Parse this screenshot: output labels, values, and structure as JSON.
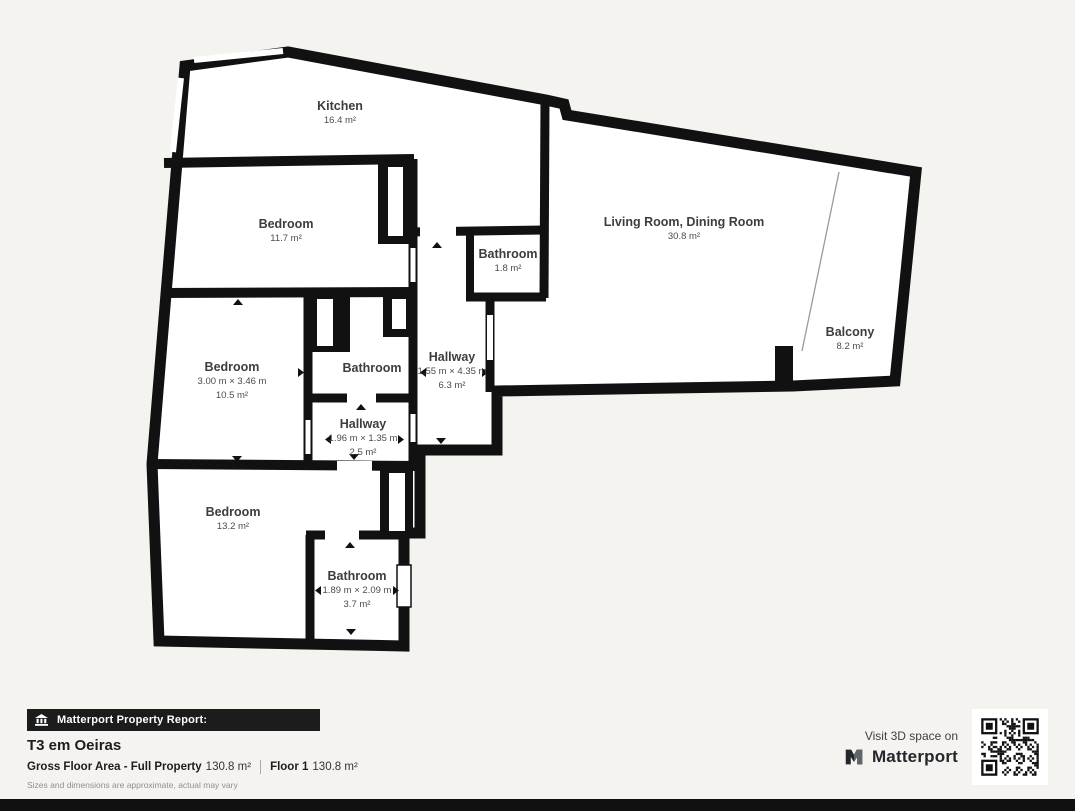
{
  "plan": {
    "rooms": [
      {
        "name": "Kitchen",
        "area": "16.4 m²"
      },
      {
        "name": "Bedroom",
        "area": "11.7 m²"
      },
      {
        "name": "Bathroom",
        "area": "1.8 m²"
      },
      {
        "name": "Living Room, Dining Room",
        "area": "30.8 m²"
      },
      {
        "name": "Balcony",
        "area": "8.2 m²"
      },
      {
        "name": "Bedroom",
        "dims": "3.00 m × 3.46 m",
        "area": "10.5 m²"
      },
      {
        "name": "Bathroom"
      },
      {
        "name": "Hallway",
        "dims": "1.55 m × 4.35 m",
        "area": "6.3 m²"
      },
      {
        "name": "Hallway",
        "dims": "1.96 m × 1.35 m",
        "area": "2.5 m²"
      },
      {
        "name": "Bedroom",
        "area": "13.2 m²"
      },
      {
        "name": "Bathroom",
        "dims": "1.89 m × 2.09 m",
        "area": "3.7 m²"
      }
    ]
  },
  "report": {
    "header": "Matterport Property Report:",
    "title": "T3 em Oeiras",
    "gross_label": "Gross Floor Area - Full Property",
    "gross_value": "130.8 m²",
    "floor_label": "Floor 1",
    "floor_value": "130.8 m²",
    "disclaimer": "Sizes and dimensions are approximate, actual may vary"
  },
  "cta": {
    "visit": "Visit 3D space on",
    "brand": "Matterport"
  },
  "icons": {
    "report_bar": "building-icon",
    "brand": "matterport-logo-icon",
    "qr": "qr-code"
  },
  "colors": {
    "wall": "#111111",
    "room_fill": "#ffffff",
    "background": "#f5f3f0",
    "report_bar": "#1c1c1c",
    "label_text": "#3d3d3d"
  }
}
